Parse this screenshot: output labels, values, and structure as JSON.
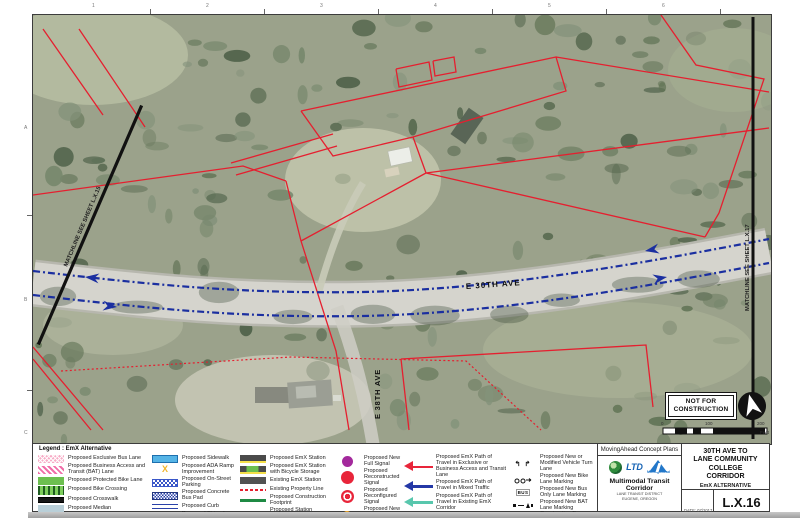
{
  "sheet": {
    "top_grid_numbers": [
      "1",
      "2",
      "3",
      "4",
      "5",
      "6"
    ],
    "left_grid_letters": [
      "A",
      "B",
      "C"
    ]
  },
  "map": {
    "street_label_e30th": "E 30TH AVE",
    "street_label_e38th": "E 38TH AVE",
    "matchline_left": "MATCHLINE SEE SHEET L.X.15",
    "matchline_right": "MATCHLINE SEE SHEET L.X.17",
    "stamp": {
      "line1": "NOT FOR",
      "line2": "CONSTRUCTION"
    },
    "scale": {
      "labels": [
        "0",
        "100",
        "200"
      ],
      "unit": "Feet"
    }
  },
  "legend": {
    "title": "Legend : EmX Alternative",
    "glyphs": {
      "turn": "↰ ↱",
      "bus": "BUS"
    },
    "columns": [
      {
        "items": [
          {
            "label": "Proposed Exclusive Bus Lane"
          },
          {
            "label": "Proposed Business Access and Transit (BAT) Lane"
          },
          {
            "label": "Proposed Protected Bike Lane"
          },
          {
            "label": "Proposed Bike Crossing"
          },
          {
            "label": "Proposed Crosswalk"
          },
          {
            "label": "Proposed Median"
          }
        ]
      },
      {
        "items": [
          {
            "label": "Proposed Sidewalk"
          },
          {
            "label": "Proposed ADA Ramp Improvement"
          },
          {
            "label": "Proposed On-Street Parking"
          },
          {
            "label": "Proposed Concrete Bus Pad"
          },
          {
            "label": "Proposed Curb"
          },
          {
            "label": "Proposed Striped or Buffered Bike Lane"
          }
        ]
      },
      {
        "items": [
          {
            "label": "Proposed EmX Station"
          },
          {
            "label": "Proposed EmX Station with Bicycle Storage"
          },
          {
            "label": "Existing EmX Station"
          },
          {
            "label": "Existing Property Line"
          },
          {
            "label": "Proposed Construction Footprint"
          },
          {
            "label": "Proposed Station Platform Edge"
          }
        ]
      },
      {
        "items": [
          {
            "label": "Proposed New Full Signal"
          },
          {
            "label": "Proposed Reconstructed Signal"
          },
          {
            "label": "Proposed Reconfigured Signal"
          },
          {
            "label": "Proposed New Pedestrian Signal"
          }
        ]
      },
      {
        "items": [
          {
            "label": "Proposed EmX Path of Travel in Exclusive or Business Access and Transit Lane"
          },
          {
            "label": "Proposed EmX Path of Travel in Mixed Traffic"
          },
          {
            "label": "Proposed EmX Path of Travel in Existing EmX Corridor"
          },
          {
            "label": "Proposed Lane Lines"
          }
        ]
      },
      {
        "items": [
          {
            "label": "Proposed New or Modified Vehicle Turn Lane"
          },
          {
            "label": "Proposed New Bike Lane Marking"
          },
          {
            "label": "Proposed New Bus Only Lane Marking"
          },
          {
            "label": "Proposed New BAT Lane Marking"
          },
          {
            "label": "Construction By Others, Proposed Pedestrian Bridge"
          }
        ]
      }
    ]
  },
  "titleblock": {
    "concept_plans": "MovingAhead Concept Plans",
    "corridor": "Multimodal Transit Corridor",
    "agency": "LANE TRANSIT DISTRICT",
    "city": "EUGENE, OREGON",
    "ltd_label": "LTD",
    "movingahead_label": "MovingAhead",
    "project_title_line1": "30TH AVE TO",
    "project_title_line2": "LANE COMMUNITY COLLEGE",
    "project_title_line3": "CORRIDOR",
    "alternative": "EmX ALTERNATIVE",
    "date": "DATE: 07/2017",
    "sheet_number": "L.X.16"
  },
  "colors": {
    "property_line_red": "#e51f2f",
    "emx_mixed_blue": "#1b2fa0",
    "emx_existing_teal": "#58c7ad",
    "signal_purple": "#a3299c",
    "signal_red": "#e8253a",
    "signal_orange": "#f6a81f",
    "protected_bike_green": "#6cbf4f",
    "sidewalk_blue": "#55b4e6",
    "station_gray": "#4a4a4a",
    "platform_yellow": "#f2e27a"
  }
}
